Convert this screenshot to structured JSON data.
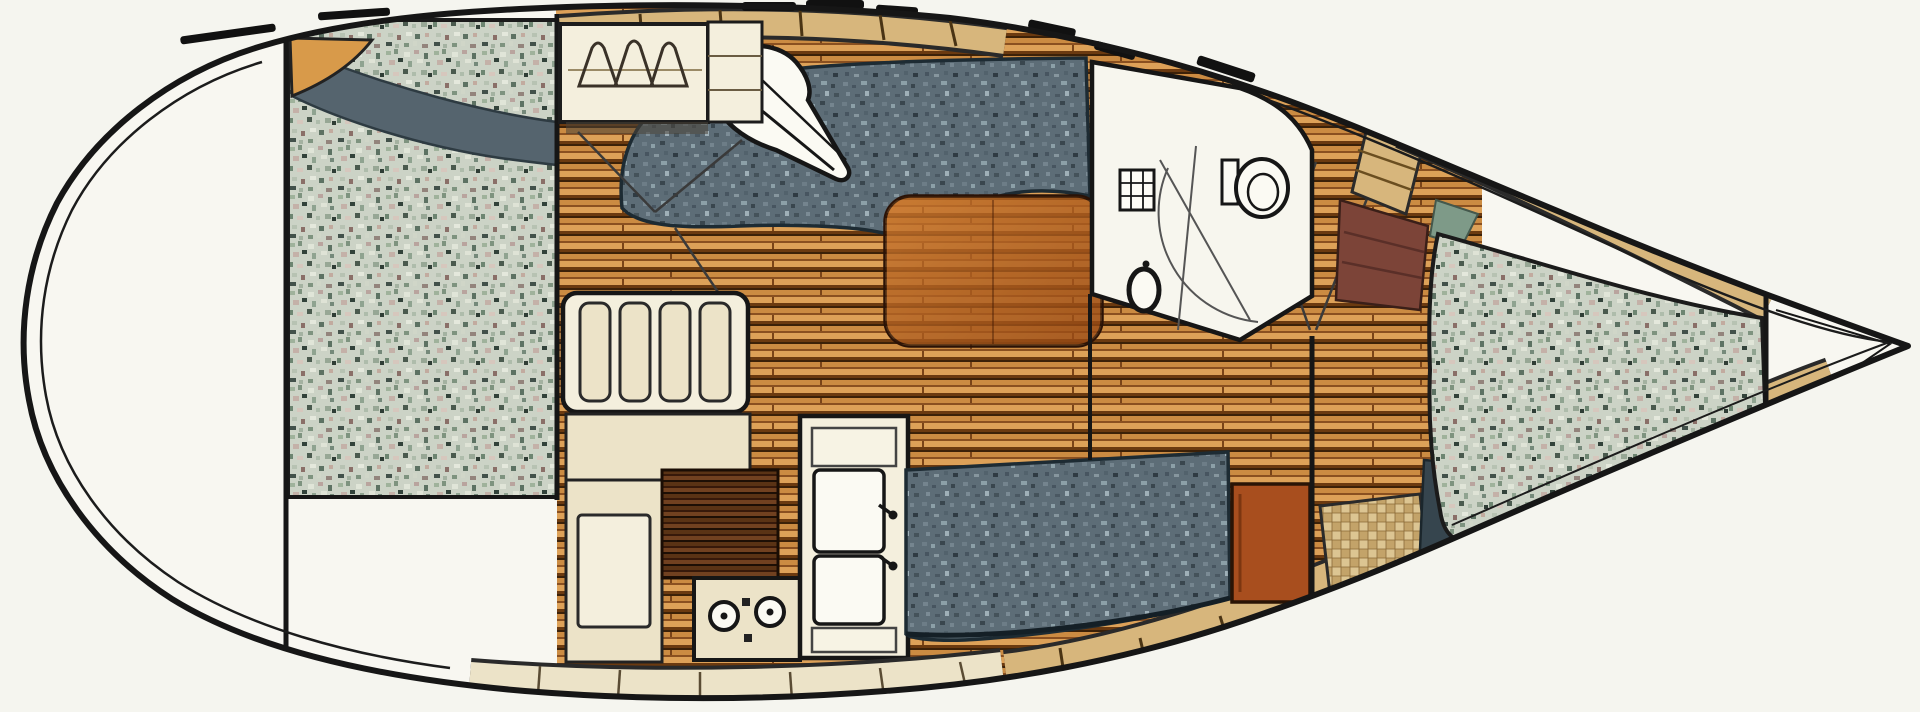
{
  "diagram": {
    "type": "boat-interior-floorplan",
    "orientation": "bow-right-stern-left",
    "fixtures": [
      "aft-cabin-berth",
      "aft-cabin-corner-shelf",
      "aft-cabin-bolster",
      "hanging-locker",
      "locker-shelf-box",
      "companionway-steps",
      "nav-seat",
      "upper-settee",
      "saloon-table",
      "lower-settee",
      "galley-icebox",
      "galley-icebox-lid",
      "galley-dark-counter",
      "galley-stove",
      "galley-double-sink",
      "head-compartment",
      "toilet",
      "head-sink",
      "shower-grate",
      "passage-bulkhead",
      "rust-cabinet",
      "checker-locker",
      "navy-wedge-seat",
      "bow-slat-locker",
      "maroon-hull-shelf",
      "vberth-mattress",
      "vberth-top-shelf",
      "vberth-bottom-shelf",
      "anchor-locker"
    ]
  },
  "palette": {
    "paper": "#f5f5ef",
    "deck": "#f8f7f1",
    "line": "#161616",
    "wood-base": "#c08038",
    "wood-hi": "#dda158",
    "wood-mid": "#cb8b42",
    "wood-low": "#8a5020",
    "wood-dark": "#6b3a10",
    "wood-line": "#3c2108",
    "dkwood-1": "#5a3315",
    "dkwood-2": "#714120",
    "dkwood-3": "#37190a",
    "granite-base": "#ccd3c6",
    "denim-base": "#5d6d77",
    "denim-dark": "#39464e",
    "cushion-edge": "#1d2b33",
    "tan-shelf": "#d7b67c",
    "cream": "#ece3c8",
    "cream-bright": "#f4efdd",
    "fixture-white": "#fbfaf3",
    "table-light": "#c8762e",
    "table-dark": "#964712",
    "rust": "#a84e1e",
    "maroon": "#7c4438",
    "navy": "#36454e",
    "green-wedge": "#7e9a88",
    "shelf-orange": "#d89a4a",
    "checker-a": "#dcc592",
    "checker-b": "#c3a369"
  }
}
